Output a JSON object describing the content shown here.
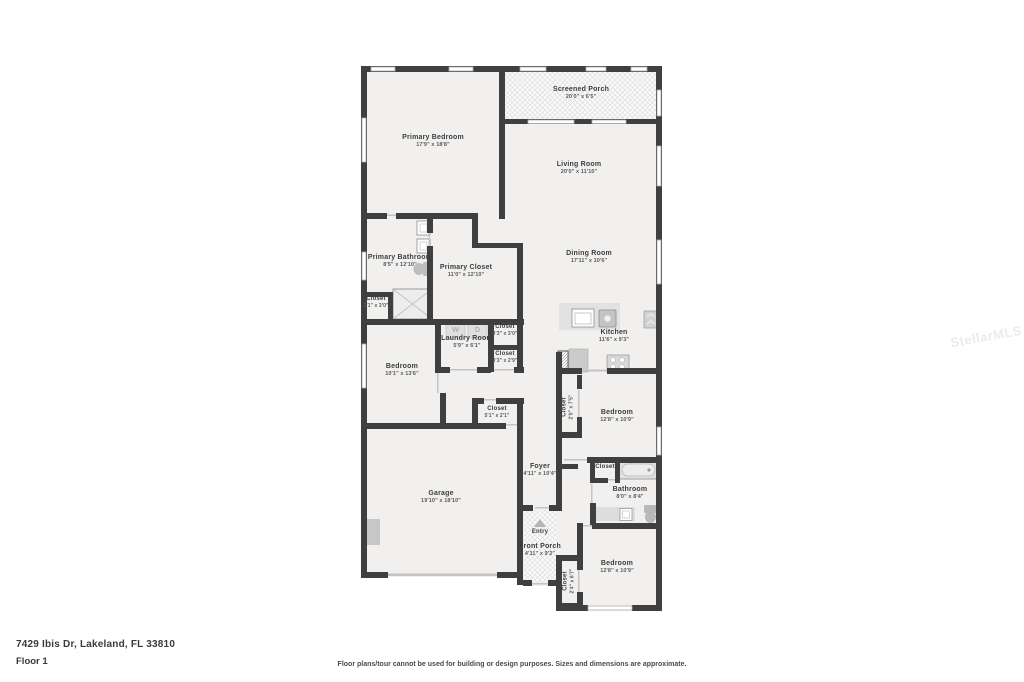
{
  "page": {
    "address": "7429 Ibis Dr, Lakeland, FL 33810",
    "floor_label": "Floor 1",
    "disclaimer": "Floor plans/tour cannot be used for building or design purposes. Sizes and dimensions are approximate.",
    "watermark": "StellarMLS"
  },
  "colors": {
    "wall": "#3f3f3f",
    "room_fill": "#f1f0ef",
    "label_text": "#3d3d3d",
    "dims_text": "#5a5a5a",
    "fixture_gray": "#d2d2d2"
  },
  "rooms": {
    "screened_porch": {
      "name": "Screened Porch",
      "dims": "20'0\" x 6'5\""
    },
    "primary_bedroom": {
      "name": "Primary Bedroom",
      "dims": "17'9\" x 18'8\""
    },
    "living_room": {
      "name": "Living Room",
      "dims": "20'0\" x 11'10\""
    },
    "dining_room": {
      "name": "Dining Room",
      "dims": "17'11\" x 10'6\""
    },
    "primary_bathroom": {
      "name": "Primary Bathroom",
      "dims": "8'5\" x 12'10\""
    },
    "primary_closet": {
      "name": "Primary Closet",
      "dims": "11'0\" x 12'10\""
    },
    "closet_bath": {
      "name": "Closet",
      "dims": "2'1\" x 3'0\""
    },
    "laundry": {
      "name": "Laundry Room",
      "dims": "5'9\" x 6'1\""
    },
    "closet_a": {
      "name": "Closet",
      "dims": "3'3\" x 3'0\""
    },
    "closet_b": {
      "name": "Closet",
      "dims": "3'3\" x 2'9\""
    },
    "kitchen": {
      "name": "Kitchen",
      "dims": "11'6\" x 9'3\""
    },
    "bedroom_left": {
      "name": "Bedroom",
      "dims": "10'1\" x 13'6\""
    },
    "closet_hall": {
      "name": "Closet",
      "dims": "5'1\" x 2'1\""
    },
    "closet_bed_mid": {
      "name": "Closet",
      "dims": "2'0\" x 7'5\""
    },
    "bedroom_mid": {
      "name": "Bedroom",
      "dims": "12'8\" x 10'9\""
    },
    "garage": {
      "name": "Garage",
      "dims": "19'10\" x 18'10\""
    },
    "foyer": {
      "name": "Foyer",
      "dims": "4'11\" x 10'4\""
    },
    "closet_bath2": {
      "name": "Closet"
    },
    "bathroom": {
      "name": "Bathroom",
      "dims": "8'0\" x 8'4\""
    },
    "entry": {
      "name": "Entry"
    },
    "front_porch": {
      "name": "Front Porch",
      "dims": "4'11\" x 9'2\""
    },
    "bedroom_bottom": {
      "name": "Bedroom",
      "dims": "12'8\" x 10'9\""
    },
    "closet_bed_bottom": {
      "name": "Closet",
      "dims": "2'4\" x 6'7\""
    }
  },
  "appliances": {
    "washer_label": "W",
    "dryer_label": "D"
  }
}
